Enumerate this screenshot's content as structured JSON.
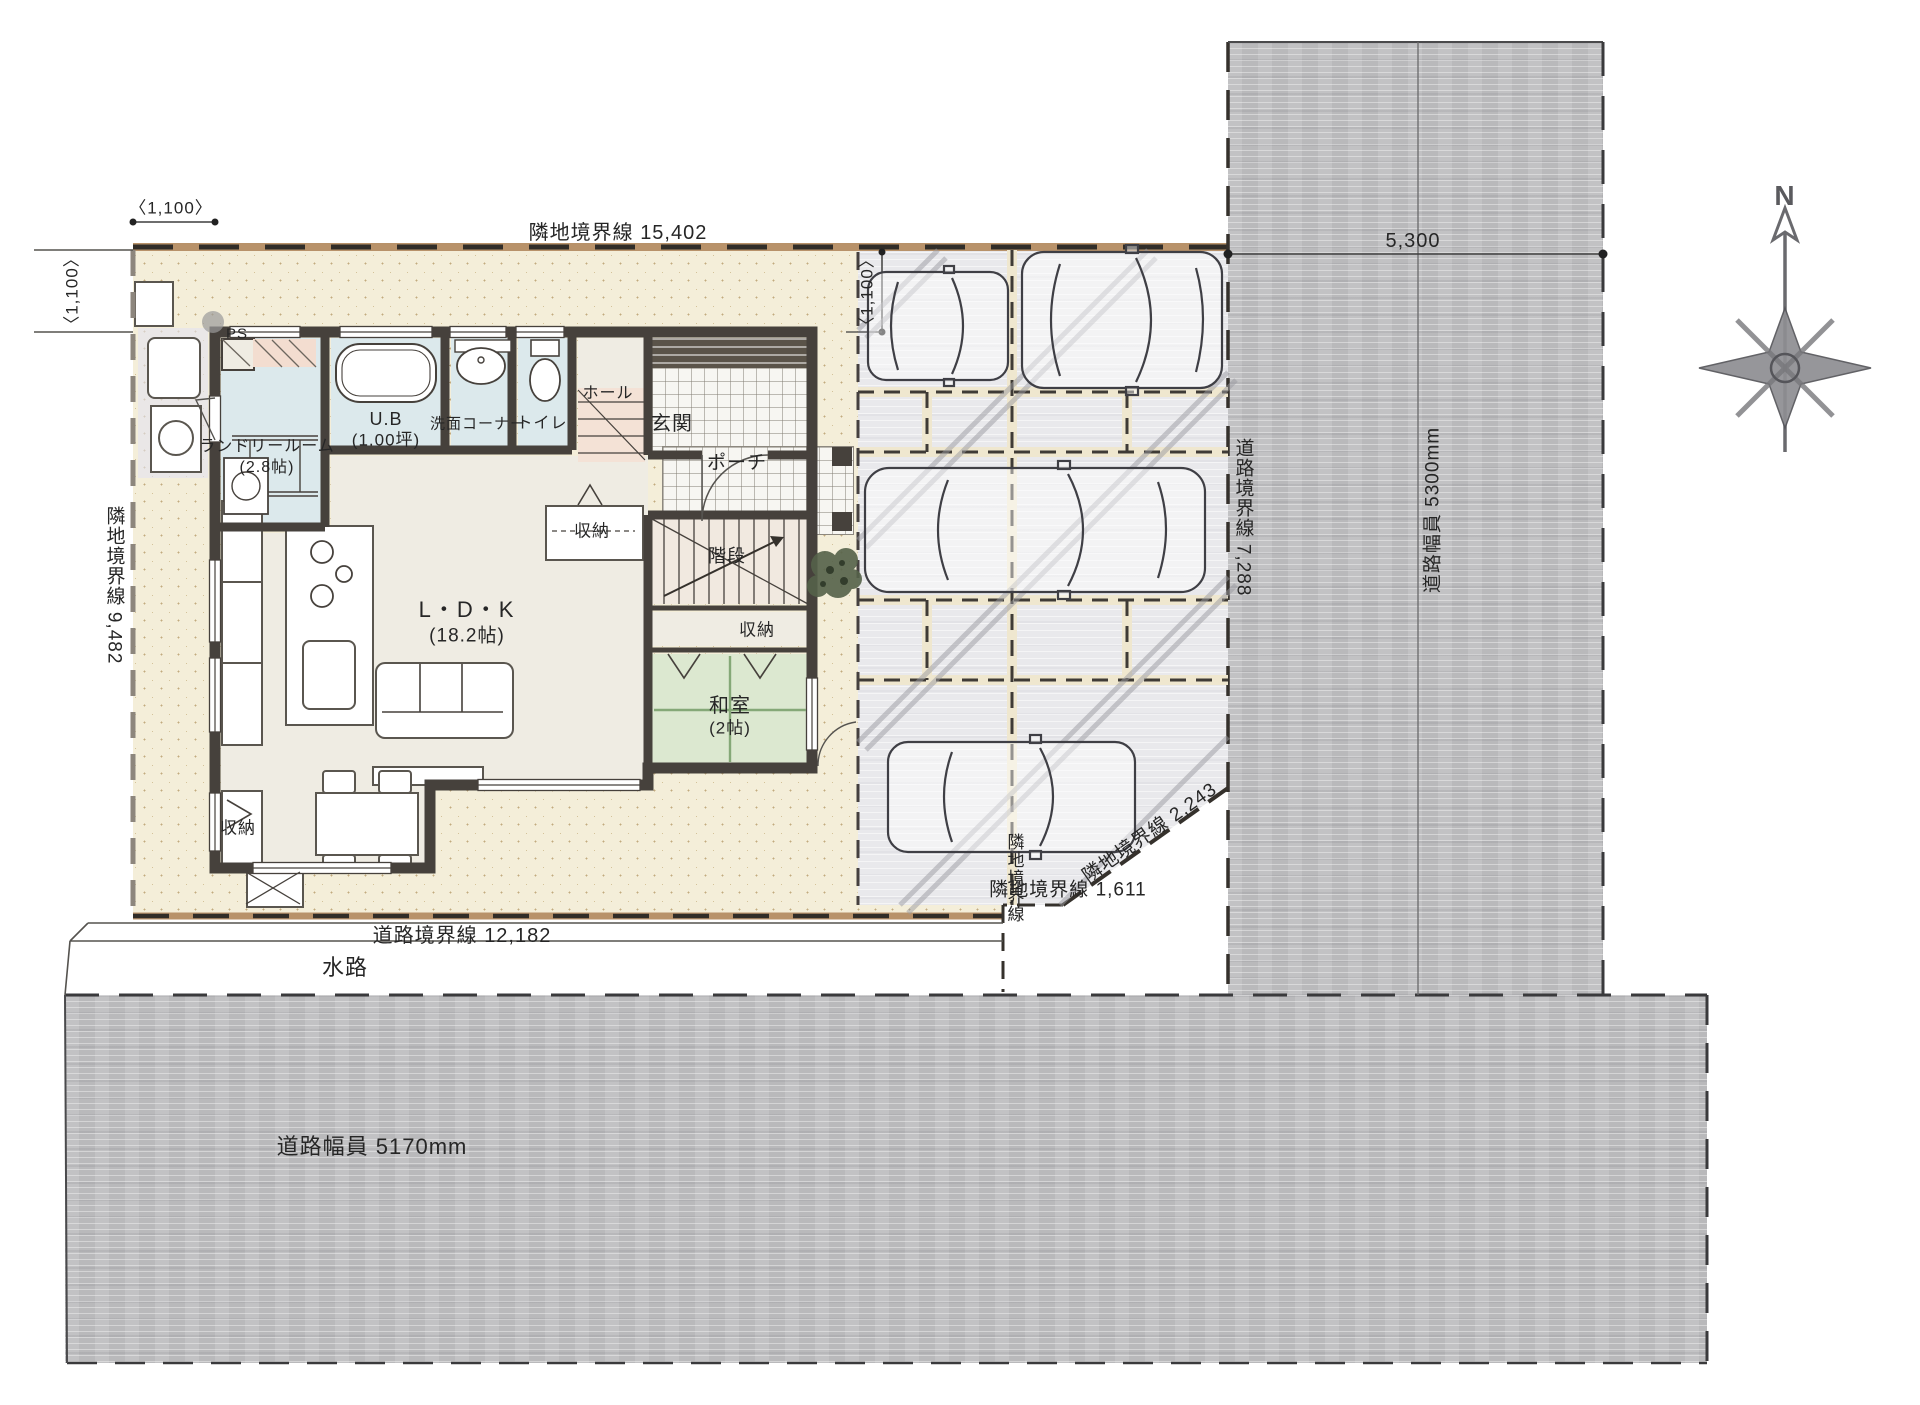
{
  "boundaries": {
    "top": "隣地境界線 15,402",
    "left": "隣地境界線 9,482",
    "bottom": "道路境界線 12,182",
    "right": "道路境界線 7,288",
    "corner_diagonal": "隣地境界線 2,243",
    "corner_horizontal": "隣地境界線 1,611",
    "corner_vertical": "隣地境界線"
  },
  "dimensions": {
    "offset_top": "〈1,100〉",
    "offset_left": "〈1,100〉",
    "offset_parking": "〈1,100〉",
    "road_right_span": "5,300",
    "road_right_width": "道路幅員 5300mm",
    "road_bottom_width": "道路幅員 5170mm"
  },
  "site": {
    "waterway": "水路",
    "compass_north": "N"
  },
  "rooms": {
    "ldk": {
      "name": "L・D・K",
      "size": "(18.2帖)"
    },
    "laundry": {
      "name": "ランドリールーム",
      "size": "(2.8帖)"
    },
    "bath": {
      "name": "U.B",
      "size": "(1.00坪)"
    },
    "wash_corner": "洗面コーナー",
    "toilet": "トイレ",
    "hall": "ホール",
    "entrance": "玄関",
    "porch": "ポーチ",
    "stairs": "階段",
    "japanese_room": {
      "name": "和室",
      "size": "(2帖)"
    },
    "storage_stairs": "収納",
    "storage_washitsu": "収納",
    "storage_dining": "収納",
    "pipe_space": "PS"
  },
  "palette": {
    "yard": "#f4eed9",
    "parking": "#e9e9ec",
    "road": "#bfbfc1",
    "wall": "#46413c",
    "wet_room": "#dce9ec",
    "tatami": "#dce8d0",
    "floor": "#efece3",
    "boundary_tan": "#b8926a"
  }
}
